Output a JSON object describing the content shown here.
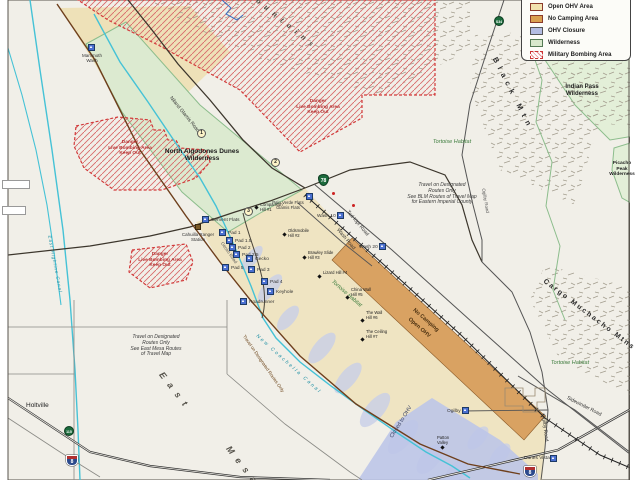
{
  "legend": {
    "items": [
      {
        "label": "Open OHV Area",
        "color": "#f2e2ae"
      },
      {
        "label": "No Camping Area",
        "color": "#d9a050"
      },
      {
        "label": "OHV Closure",
        "color": "#b3bce2"
      },
      {
        "label": "Wilderness",
        "color": "#d8e8cc"
      },
      {
        "label": "Military Bombing Area",
        "color": "#cc3333"
      }
    ]
  },
  "regions": {
    "mountains": "Mountains",
    "black_mtn": "Black Mtn",
    "cargo_muchacho": "Cargo Muchacho Mtns",
    "east": "East",
    "mesa": "Mesa",
    "indian_pass": "Indian Pass Wilderness",
    "picacho_l1": "Picacho",
    "picacho_l2": "Peak",
    "picacho_l3": "Wilderness",
    "algodones_l1": "North Algodones Dunes",
    "algodones_l2": "Wilderness",
    "tortoise_habitat": "Tortoise Habitat",
    "no_camping_l1": "No Camping",
    "no_camping_l2": "Open OHV",
    "closed_to_ohv": "Closed to OHV"
  },
  "danger": {
    "l1": "Danger",
    "l2": "Live Bombing Area",
    "l3": "Keep Out"
  },
  "notes": {
    "blm": [
      "Travel on Designated",
      "Routes Only",
      "See BLM Routes of Travel Map",
      "for Eastern Imperial County"
    ],
    "mesa": [
      "Travel on Designated",
      "Routes Only",
      "See East Mesa Routes",
      "of Travel Map"
    ]
  },
  "roads": {
    "niland_glamis": "Niland Glamis Road",
    "ted_kipf": "Ted Kipf Road",
    "wash_road": "Wash Road",
    "gecko_road": "Gecko Road",
    "ogilby_road": "Ogilby Road",
    "sidewinder": "Sidewinder Road",
    "travel_designated": "Travel on Designated Routes Only"
  },
  "canals": {
    "coachella": "New Coachella Canal",
    "highline": "East Highline Canal"
  },
  "towns": {
    "holtville": "Holtville"
  },
  "camps": {
    "mammoth": "Mammoth Wash",
    "cement": "Cement Flats",
    "cahuilla": "Cahuilla Ranger Station",
    "pad1": "Pad 1",
    "pad15": "Pad 1.5",
    "pad2": "Pad 2",
    "pad25": "Pad 2.5",
    "gecko": "Gecko",
    "pad3": "Pad 3",
    "pad4": "Pad 4",
    "pad5": "Pad 5",
    "keyhole": "Keyhole",
    "roadrunner": "Roadrunner",
    "paloverde_l1": "Palo Verde Flats",
    "paloverde_l2": "Glamis Flats",
    "wash10": "Wash 10",
    "wash20": "Wash 20",
    "ogilby": "Ogilby",
    "dunes_vista": "Dunes Vista"
  },
  "hills": {
    "comparison": {
      "name": "Comparison",
      "num": "Hill #1"
    },
    "oldsmobile": {
      "name": "Oldsmobile",
      "num": "Hill #2"
    },
    "brawley": {
      "name": "Brawley Slide",
      "num": "Hill #3"
    },
    "lizard": {
      "name": "Lizard Hill #4",
      "num": ""
    },
    "china": {
      "name": "China Wall",
      "num": "Hill #5"
    },
    "wall": {
      "name": "The Wall",
      "num": "Hill #6"
    },
    "ceiling": {
      "name": "The Ceiling",
      "num": "Hill #7"
    },
    "patton": {
      "name": "Patton",
      "num": "Valley"
    }
  },
  "markers": {
    "m1": "1",
    "m2": "2",
    "m3": "3"
  },
  "shields": {
    "i8": "8",
    "ca78": "78",
    "s34": "S34",
    "ca115": "115"
  },
  "colors": {
    "open_ohv": "#eee1b8",
    "no_camping": "#d9a262",
    "ohv_closure": "#bcc5e8",
    "wilderness": "#dcead0",
    "military": "#cc3333",
    "canal": "#45c2d6",
    "boundary_road": "#6e3f1c",
    "background": "#f1efe8"
  }
}
